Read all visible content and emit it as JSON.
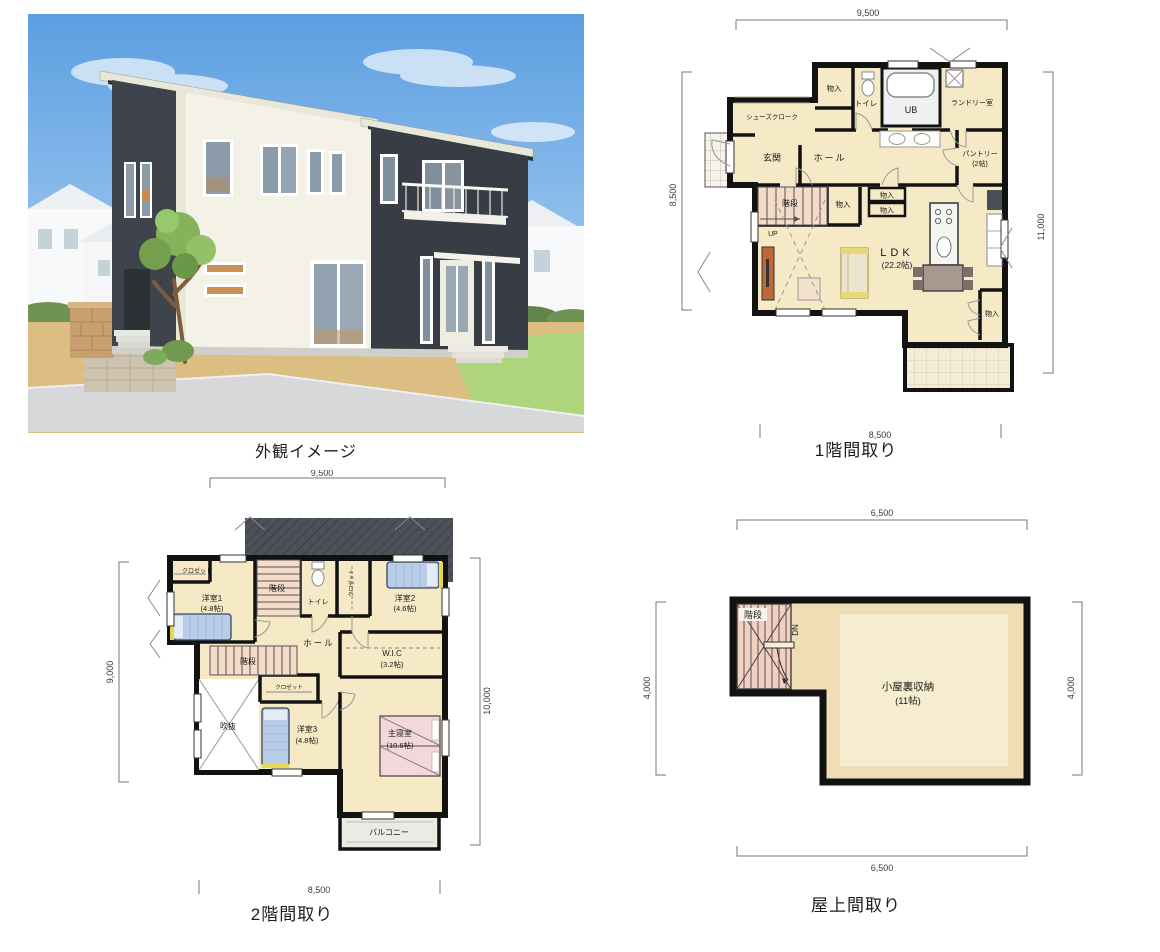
{
  "exterior": {
    "caption": "外観イメージ"
  },
  "floor1": {
    "title": "1階間取り",
    "dim_top": "9,500",
    "dim_left": "8,500",
    "dim_right": "11,000",
    "dim_bottom": "8,500",
    "labels": {
      "storage_top": "物入",
      "toilet": "トイレ",
      "bath": "UB",
      "laundry": "ランドリー室",
      "shoe_closet": "シューズクローク",
      "entrance": "玄関",
      "hall": "ホール",
      "pantry": "パントリー",
      "pantry_size": "(2帖)",
      "stairs": "階段",
      "up": "UP",
      "storage_stairs": "物入",
      "storage_a": "物入",
      "storage_b": "物入",
      "ldk": "LDK",
      "ldk_size": "(22.2帖)",
      "storage_right": "物入"
    }
  },
  "floor2": {
    "title": "2階間取り",
    "dim_top": "9,500",
    "dim_left": "9,000",
    "dim_right": "10,000",
    "dim_bottom": "8,500",
    "labels": {
      "closet1": "クロゼット",
      "room1": "洋室1",
      "room1_size": "(4.8帖)",
      "stairs_upper": "階段",
      "toilet": "トイレ",
      "closet2": "クロゼット",
      "room2": "洋室2",
      "room2_size": "(4.6帖)",
      "hall": "ホール",
      "wic": "W.I.C",
      "wic_size": "(3.2帖)",
      "stairs_mid": "階段",
      "closet3": "クロゼット",
      "void": "吹抜",
      "room3": "洋室3",
      "room3_size": "(4.8帖)",
      "master": "主寝室",
      "master_size": "(10.6帖)",
      "balcony": "バルコニー"
    }
  },
  "roof": {
    "title": "屋上間取り",
    "dim_top": "6,500",
    "dim_left": "4,000",
    "dim_right": "4,000",
    "dim_bottom": "6,500",
    "labels": {
      "stairs": "階段",
      "dn": "DN",
      "attic": "小屋裏収納",
      "attic_size": "(11帖)"
    }
  },
  "colors": {
    "wall": "#121212",
    "floor": "#f6e9c6",
    "stairs": "#f4dcc8",
    "dark_siding": "#3f444c",
    "white_siding": "#f4f1e7",
    "sky": "#5b9fe2",
    "lawn": "#aed47c",
    "dirt": "#dcbd82",
    "road": "#d6d8da",
    "bed_blue": "#b9cde9",
    "bed_pink": "#f2d8dc",
    "tv_board": "#c06838"
  }
}
